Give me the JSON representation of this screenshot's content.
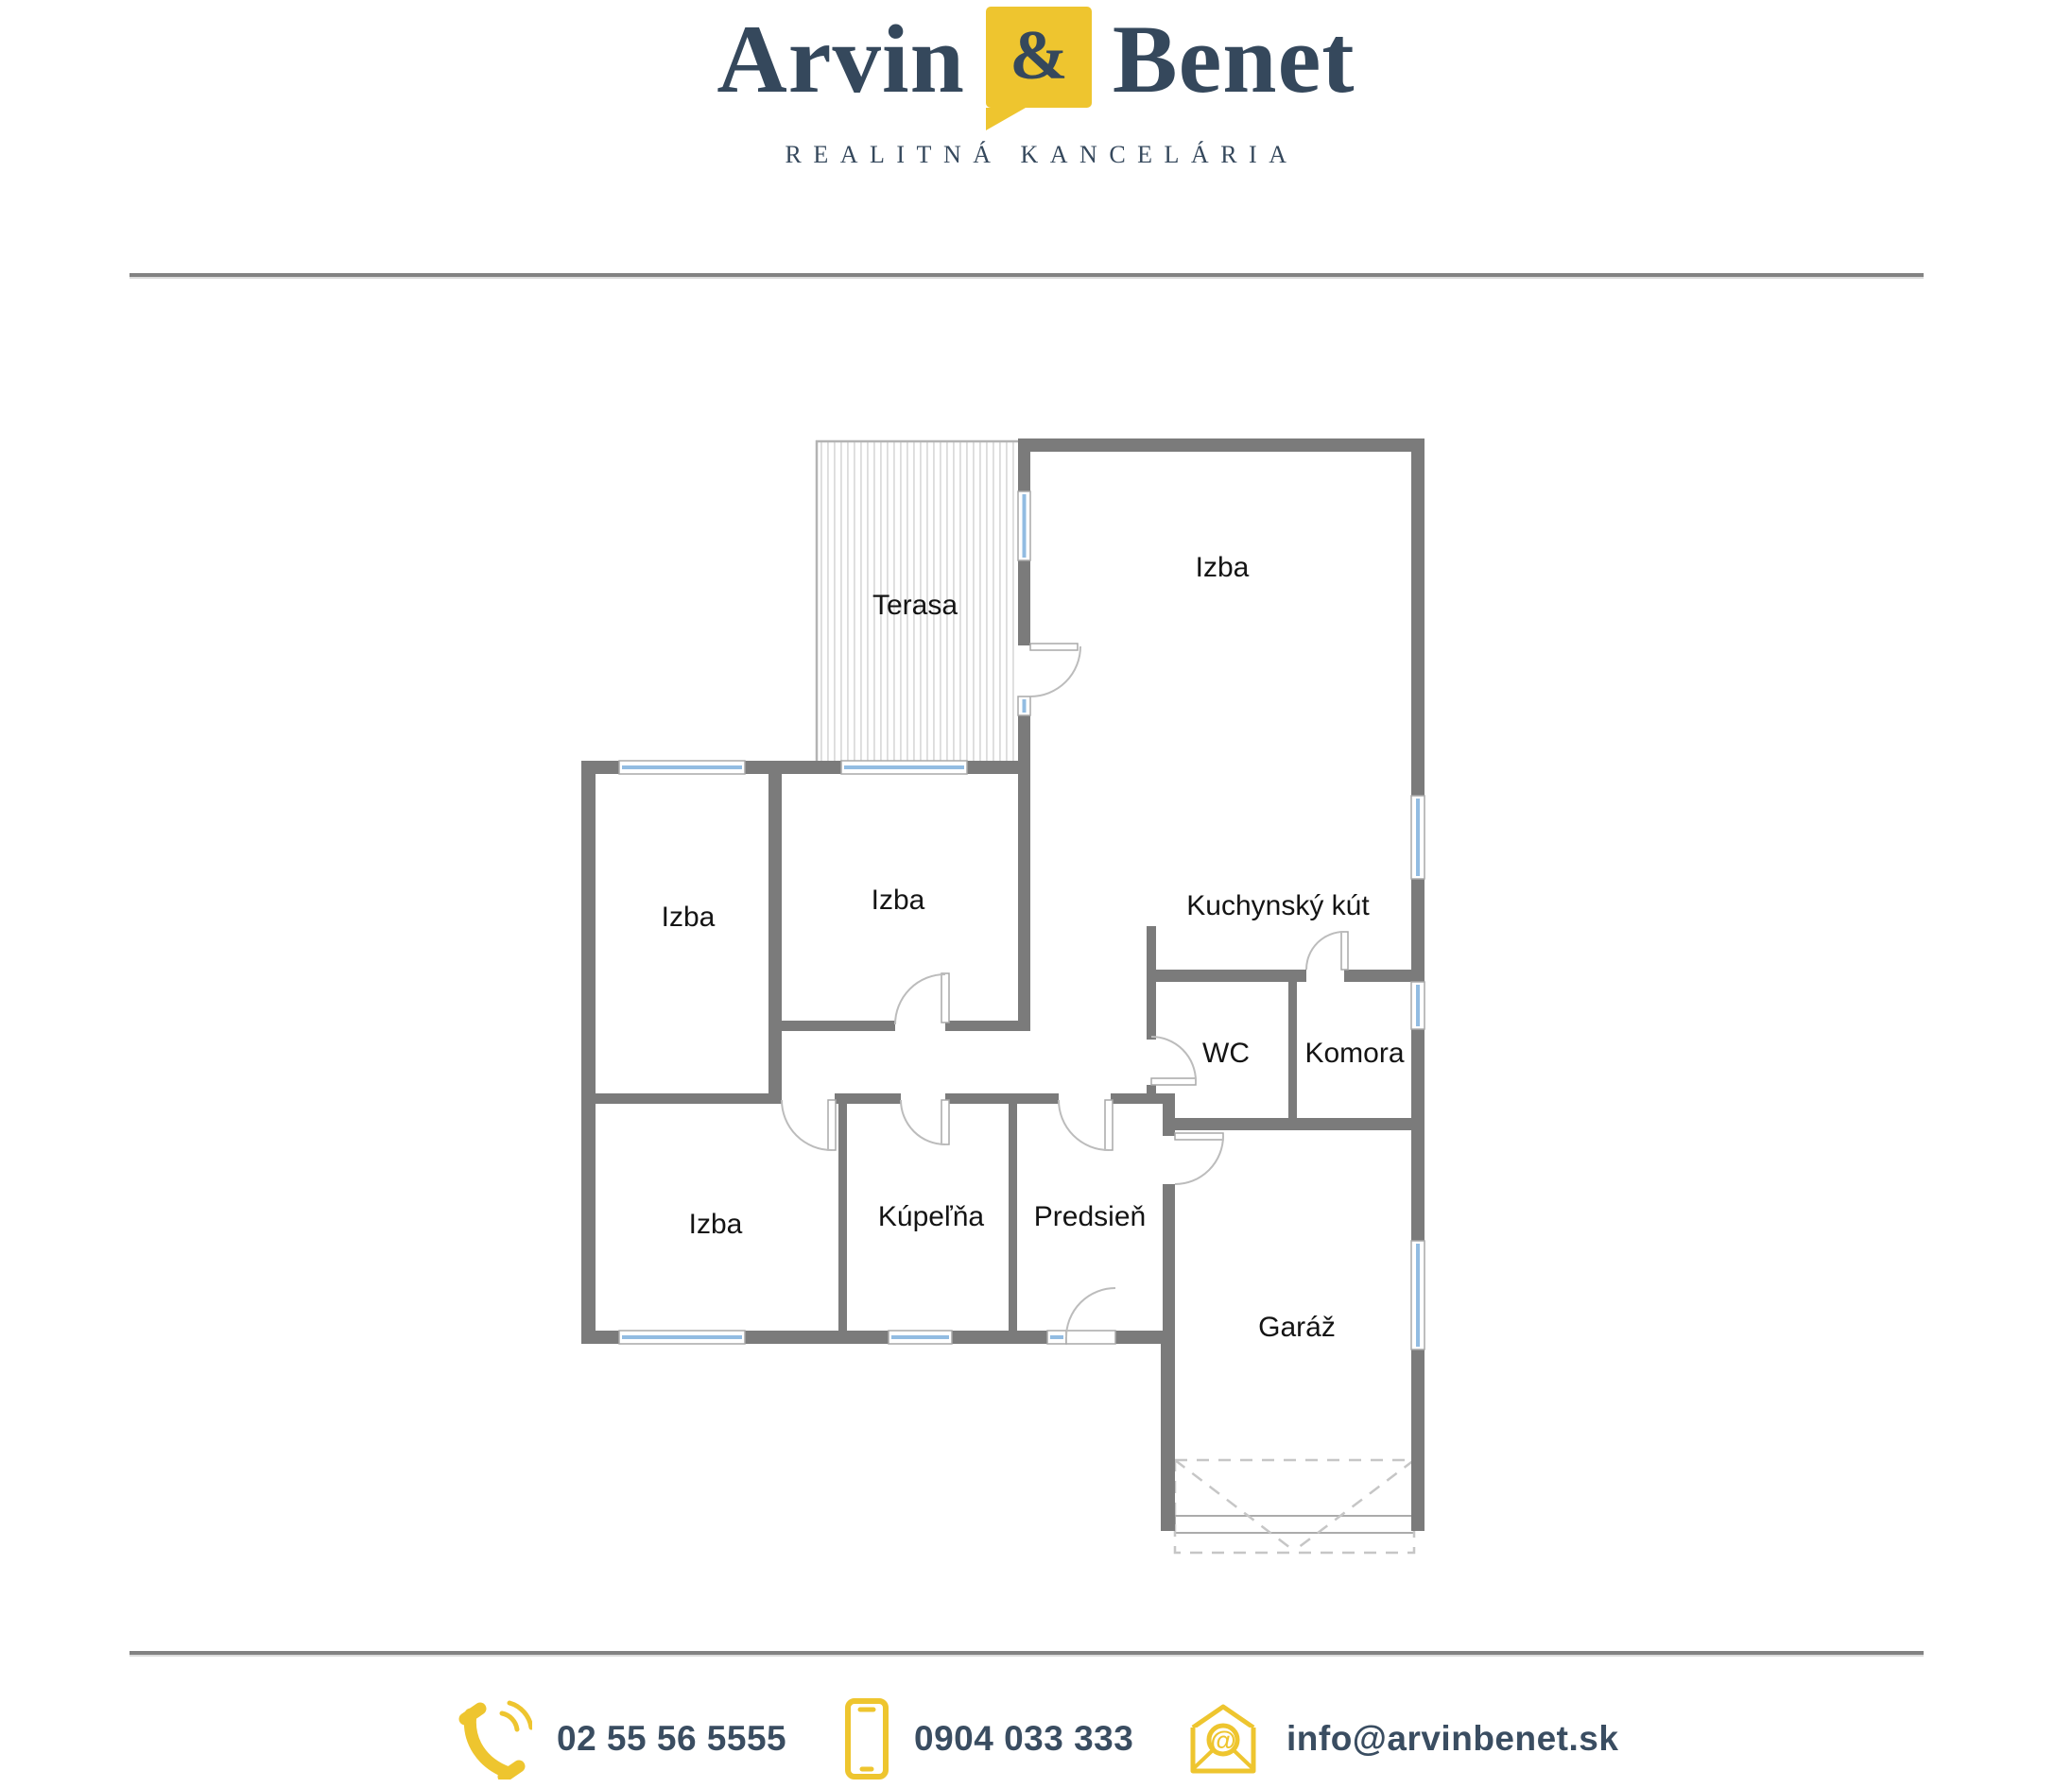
{
  "brand": {
    "name_first": "Arvin",
    "ampersand": "&",
    "name_second": "Benet",
    "tagline": "REALITNÁ KANCELÁRIA"
  },
  "floorplan": {
    "rooms": [
      {
        "id": "terasa",
        "label": "Terasa"
      },
      {
        "id": "izba-living",
        "label": "Izba"
      },
      {
        "id": "izba-left",
        "label": "Izba"
      },
      {
        "id": "izba-middle",
        "label": "Izba"
      },
      {
        "id": "kuchynsky-kut",
        "label": "Kuchynský kút"
      },
      {
        "id": "wc",
        "label": "WC"
      },
      {
        "id": "komora",
        "label": "Komora"
      },
      {
        "id": "izba-bottom",
        "label": "Izba"
      },
      {
        "id": "kupelna",
        "label": "Kúpeľňa"
      },
      {
        "id": "predsien",
        "label": "Predsieň"
      },
      {
        "id": "garaz",
        "label": "Garáž"
      }
    ]
  },
  "contact": {
    "landline": "02 55 56 5555",
    "mobile": "0904 033 333",
    "email": "info@arvinbenet.sk",
    "at_glyph": "@"
  },
  "colors": {
    "brand_navy": "#35485c",
    "brand_yellow": "#eec52f",
    "wall_gray": "#7b7b7b",
    "window_blue": "#92bce2"
  }
}
